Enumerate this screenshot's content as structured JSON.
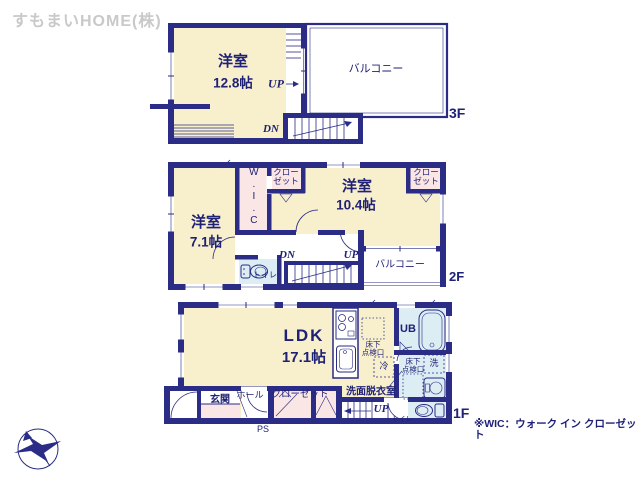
{
  "watermark": "すもまいHOME(株)",
  "note": "※WIC：ウォーク イン クローゼット",
  "colors": {
    "wall": "#2a2c85",
    "cream": "#f8efcd",
    "pink": "#fae6e4",
    "blue": "#dcedf3",
    "text": "#1f2176",
    "wm": "#c9c9c9"
  },
  "icons": {
    "compass": "north-compass-bird-arrow",
    "toilet": "toilet-plan-symbol",
    "bathtub": "bathtub-plan-symbol",
    "stove": "stove-plan-symbol",
    "sink": "kitchen-sink-plan-symbol",
    "basin": "washbasin-plan-symbol"
  },
  "floor3": {
    "label": "3F",
    "room_name": "洋室",
    "room_size": "12.8帖",
    "balcony": "バルコニー",
    "up": "UP",
    "dn": "DN"
  },
  "floor2": {
    "label": "2F",
    "room_east_name": "洋室",
    "room_east_size": "10.4帖",
    "room_west_name": "洋室",
    "room_west_size": "7.1帖",
    "wic": "W.I.C",
    "closet_west": "クロー\nゼット",
    "closet_east": "クロー\nゼット",
    "toilet": "トイレ",
    "balcony": "バルコニー",
    "dn": "DN",
    "up": "UP"
  },
  "floor1": {
    "label": "1F",
    "ldk_name": "LDK",
    "ldk_size": "17.1帖",
    "entrance": "玄関",
    "hall": "ホール",
    "closet": "クローゼット",
    "ps": "PS",
    "washroom": "洗面脱衣室",
    "unit_bath": "UB",
    "fridge": "冷",
    "washer": "洗",
    "hatch_kitchen": "床下\n点検口",
    "hatch_washroom": "床下\n点検口",
    "toilet": "トイレ",
    "up": "UP"
  }
}
